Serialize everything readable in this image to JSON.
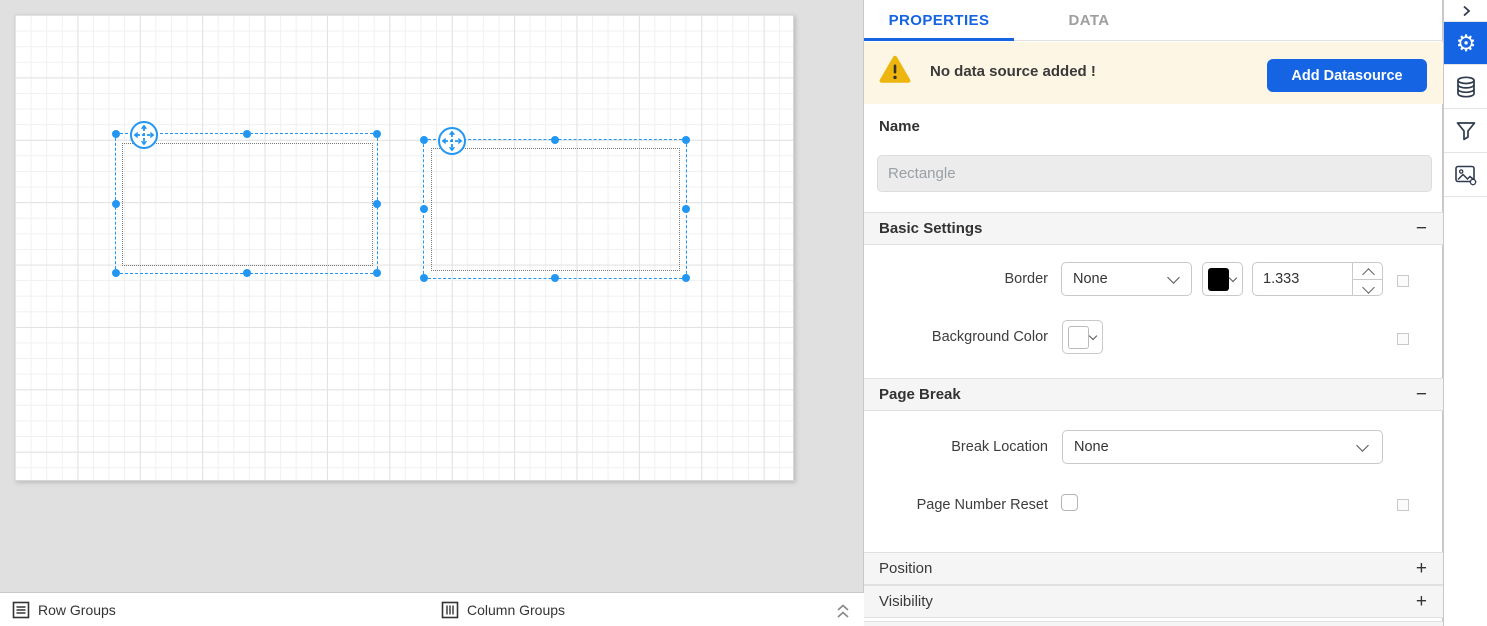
{
  "tabs": {
    "properties": "PROPERTIES",
    "data": "DATA"
  },
  "banner": {
    "message": "No data source added !",
    "add_button": "Add Datasource"
  },
  "name_field": {
    "label": "Name",
    "placeholder": "Rectangle"
  },
  "basic_settings": {
    "title": "Basic Settings",
    "border_label": "Border",
    "border_style": "None",
    "border_color": "#000000",
    "border_width": "1.333",
    "background_label": "Background Color",
    "background_color": "#ffffff"
  },
  "page_break": {
    "title": "Page Break",
    "break_location_label": "Break Location",
    "break_location": "None",
    "page_number_reset_label": "Page Number Reset"
  },
  "position": {
    "title": "Position"
  },
  "visibility": {
    "title": "Visibility"
  },
  "footer": {
    "row_groups": "Row Groups",
    "column_groups": "Column Groups"
  },
  "icons": {
    "collapse": "−",
    "expand": "+",
    "gear": "⚙"
  },
  "colors": {
    "accent": "#1464e4",
    "selection_blue": "#2196f3",
    "warning_yellow": "#edb50d",
    "banner_bg": "#fdf6e4"
  }
}
